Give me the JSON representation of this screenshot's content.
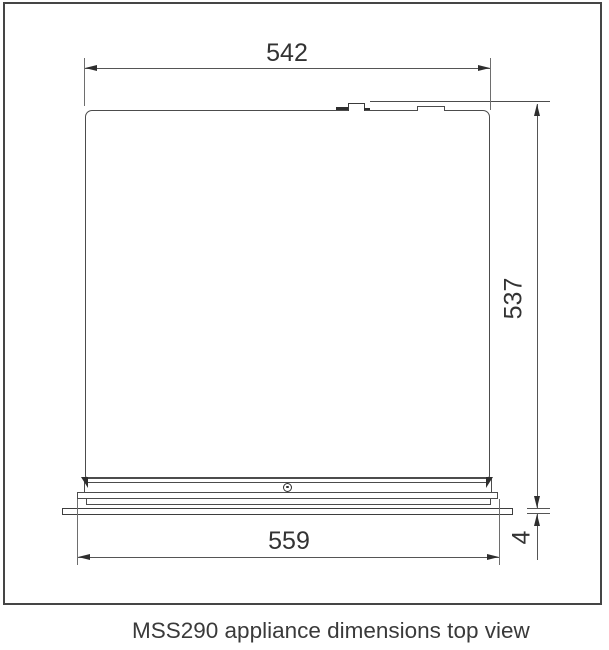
{
  "figure": {
    "caption": "MSS290 appliance dimensions top view"
  },
  "dimensions": {
    "width_top": "542",
    "depth_side": "537",
    "width_front": "559",
    "trim_thickness": "4"
  },
  "colors": {
    "line": "#4c4c4c",
    "extension_line": "#6e6e6e",
    "arrow_and_text": "#2e2e2e",
    "frame": "#454545",
    "background": "#ffffff"
  }
}
